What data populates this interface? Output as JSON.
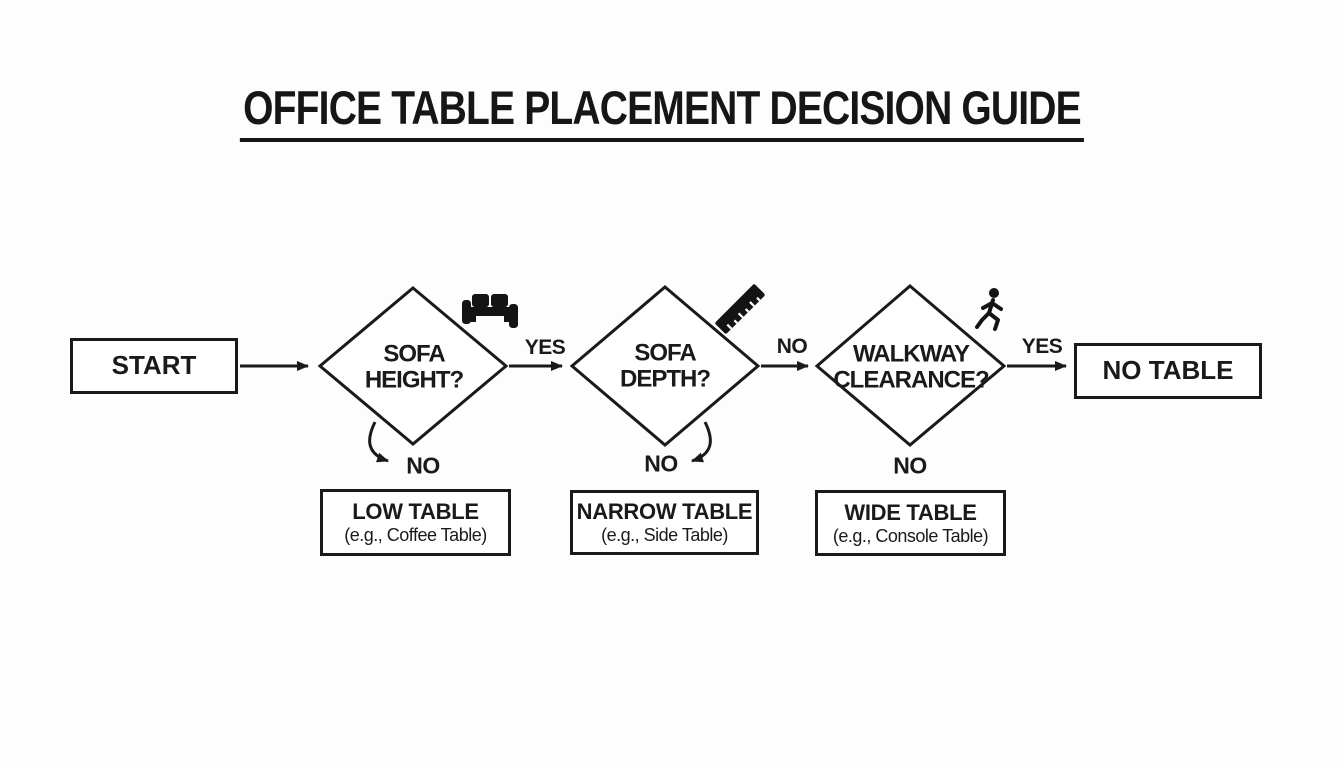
{
  "title": "OFFICE TABLE PLACEMENT DECISION GUIDE",
  "flow": {
    "start": "START",
    "decision1": {
      "line1": "SOFA",
      "line2": "HEIGHT?"
    },
    "decision2": {
      "line1": "SOFA",
      "line2": "DEPTH?"
    },
    "decision3": {
      "line1": "WALKWAY",
      "line2": "CLEARANCE?"
    },
    "terminal": "NO TABLE"
  },
  "edge_labels": {
    "d1_yes": "YES",
    "d1_no": "NO",
    "d2_no_right": "NO",
    "d2_no_down": "NO",
    "d3_yes": "YES",
    "d3_no": "NO"
  },
  "results": [
    {
      "title": "LOW TABLE",
      "subtitle": "(e.g., Coffee Table)"
    },
    {
      "title": "NARROW TABLE",
      "subtitle": "(e.g., Side Table)"
    },
    {
      "title": "WIDE TABLE",
      "subtitle": "(e.g., Console Table)"
    }
  ],
  "icons": [
    "sofa-icon",
    "ruler-icon",
    "walking-person-icon"
  ],
  "colors": {
    "ink": "#1a1a1a",
    "background": "#fdfdfd"
  }
}
